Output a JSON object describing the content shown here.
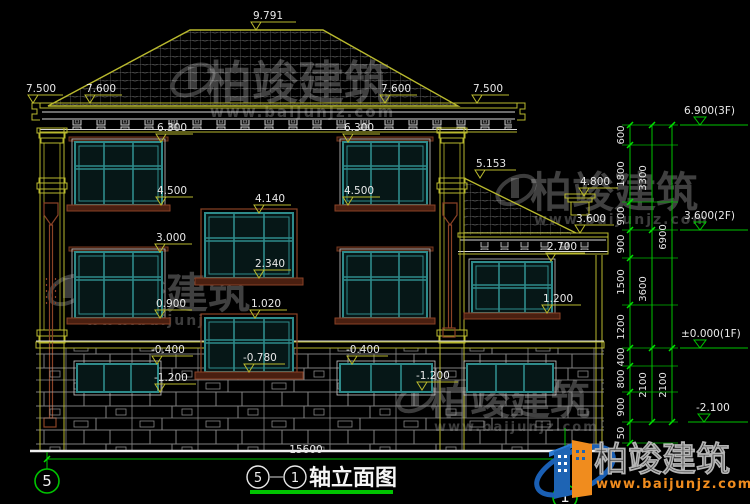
{
  "drawing": {
    "marks": {
      "peak": "9.791",
      "eave_left_outer": "7.500",
      "eave_left_inner": "7.600",
      "eave_right_inner": "7.600",
      "eave_right_outer": "7.500",
      "win2f_left_top": "6.300",
      "win2f_left_sill": "4.500",
      "win2f_right_top": "6.300",
      "win2f_right_sill": "4.500",
      "annex_ridge": "5.153",
      "annex_chimney": "4.800",
      "annex_eave": "3.600",
      "annex_fascia": "2.700",
      "annex_window_sill": "1.200",
      "stair_upper_top": "4.140",
      "stair_upper_sill": "2.340",
      "stair_lower_top": "1.020",
      "stair_lower_sill": "-0.780",
      "win1f_left_top": "3.000",
      "win1f_left_sill": "0.900",
      "base_left_top": "-0.400",
      "base_left_sill": "-1.200",
      "base_mid_top": "-0.400",
      "base_mid_sill": "-1.200"
    },
    "chain": {
      "col1": [
        "600",
        "1800",
        "900",
        "900",
        "1500",
        "1200",
        "400",
        "800",
        "900",
        "50"
      ],
      "col2": [
        "3300",
        "3600",
        "2100"
      ],
      "col3": [
        "6900",
        "2100"
      ]
    },
    "levels": {
      "f3": "6.900(3F)",
      "f2": "3.600(2F)",
      "f1": "±0.000(1F)",
      "basement": "-2.100"
    },
    "footer": {
      "total_width": "15600",
      "axis_left": "5",
      "axis_right": "1"
    },
    "title": {
      "axis_a": "5",
      "axis_b": "1",
      "name": "轴立面图"
    },
    "watermark": {
      "name": "柏竣建筑",
      "url": "www.baijunjz.com"
    },
    "logo": {
      "name": "柏竣建筑",
      "url": "www.baijunjz.com"
    },
    "colors": {
      "line_yellow": "#b9b92e",
      "dim_green": "#00c400",
      "window_teal": "#2e8b8b",
      "trim_maroon": "#7a3a20",
      "logo_blue": "#1e64b4",
      "logo_orange": "#f08c1e"
    }
  }
}
